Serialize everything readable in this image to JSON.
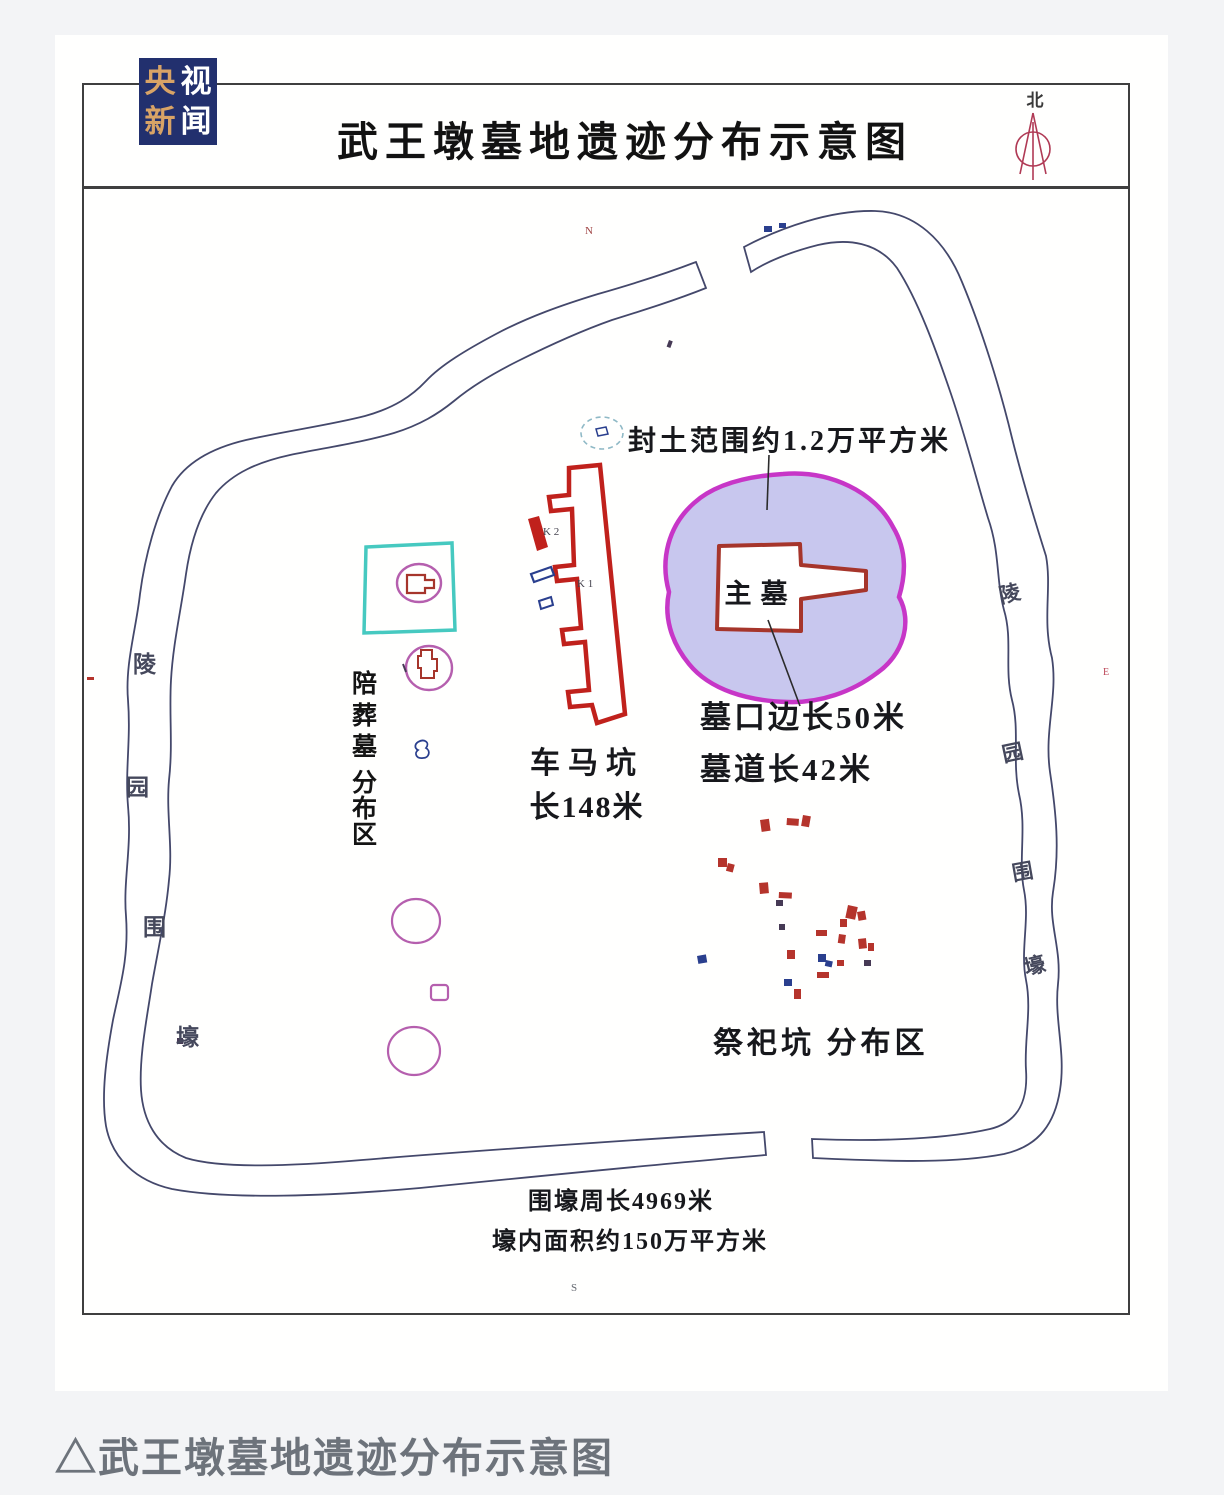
{
  "header": {
    "title": "武王墩墓地遗迹分布示意图",
    "north_label": "北"
  },
  "logo": {
    "rows": [
      [
        "央",
        "视"
      ],
      [
        "新",
        "闻"
      ]
    ]
  },
  "map": {
    "fengtu_label": "封土范围约1.2万平方米",
    "main_tomb": "主墓",
    "tomb_mouth": "墓口边长50米",
    "tomb_passage": "墓道长42米",
    "chariot_line1": "车马坑",
    "chariot_line2": "长148米",
    "k1": "K 1",
    "k2": "K 2",
    "accompany_chars": [
      "陪",
      "葬",
      "墓",
      "分",
      "布",
      "区"
    ],
    "sacrificial_label": "祭祀坑 分布区",
    "moat_left_chars": [
      "陵",
      "园",
      "围",
      "壕"
    ],
    "moat_right_chars": [
      "陵",
      "园",
      "围",
      "壕"
    ],
    "perimeter": "围壕周长4969米",
    "inner_area": "壕内面积约150万平方米",
    "tiny_marks": {
      "top": "N",
      "bottom": "S",
      "right": "E"
    },
    "marks": [
      {
        "x": 760,
        "y": 820,
        "w": 9,
        "h": 12,
        "f": "#b5342c",
        "r": -8
      },
      {
        "x": 787,
        "y": 818,
        "w": 12,
        "h": 7,
        "f": "#b5342c",
        "r": 4
      },
      {
        "x": 803,
        "y": 815,
        "w": 8,
        "h": 11,
        "f": "#b5342c",
        "r": 10
      },
      {
        "x": 718,
        "y": 858,
        "w": 9,
        "h": 9,
        "f": "#b5342c",
        "r": 0
      },
      {
        "x": 728,
        "y": 863,
        "w": 7,
        "h": 8,
        "f": "#b5342c",
        "r": 15
      },
      {
        "x": 759,
        "y": 883,
        "w": 9,
        "h": 11,
        "f": "#b5342c",
        "r": -5
      },
      {
        "x": 779,
        "y": 892,
        "w": 13,
        "h": 6,
        "f": "#b5342c",
        "r": 3
      },
      {
        "x": 776,
        "y": 900,
        "w": 7,
        "h": 6,
        "f": "#463a55",
        "r": 0
      },
      {
        "x": 848,
        "y": 905,
        "w": 10,
        "h": 13,
        "f": "#b5342c",
        "r": 12
      },
      {
        "x": 857,
        "y": 912,
        "w": 8,
        "h": 9,
        "f": "#b5342c",
        "r": -10
      },
      {
        "x": 840,
        "y": 919,
        "w": 7,
        "h": 8,
        "f": "#b5342c",
        "r": 0
      },
      {
        "x": 779,
        "y": 924,
        "w": 6,
        "h": 6,
        "f": "#463a55",
        "r": 0
      },
      {
        "x": 816,
        "y": 930,
        "w": 11,
        "h": 6,
        "f": "#b5342c",
        "r": 0
      },
      {
        "x": 839,
        "y": 934,
        "w": 7,
        "h": 9,
        "f": "#b5342c",
        "r": 8
      },
      {
        "x": 858,
        "y": 939,
        "w": 8,
        "h": 10,
        "f": "#b5342c",
        "r": -6
      },
      {
        "x": 868,
        "y": 943,
        "w": 6,
        "h": 8,
        "f": "#b5342c",
        "r": 0
      },
      {
        "x": 787,
        "y": 950,
        "w": 8,
        "h": 9,
        "f": "#b5342c",
        "r": 0
      },
      {
        "x": 697,
        "y": 956,
        "w": 9,
        "h": 8,
        "f": "#2a3f8e",
        "r": -10
      },
      {
        "x": 818,
        "y": 954,
        "w": 8,
        "h": 8,
        "f": "#2a3f8e",
        "r": 0
      },
      {
        "x": 826,
        "y": 960,
        "w": 7,
        "h": 6,
        "f": "#2a3f8e",
        "r": 12
      },
      {
        "x": 837,
        "y": 960,
        "w": 7,
        "h": 6,
        "f": "#b5342c",
        "r": 0
      },
      {
        "x": 864,
        "y": 960,
        "w": 7,
        "h": 6,
        "f": "#463a55",
        "r": 0
      },
      {
        "x": 817,
        "y": 972,
        "w": 12,
        "h": 6,
        "f": "#b5342c",
        "r": 0
      },
      {
        "x": 784,
        "y": 979,
        "w": 8,
        "h": 7,
        "f": "#2a3f8e",
        "r": 0
      },
      {
        "x": 794,
        "y": 989,
        "w": 7,
        "h": 10,
        "f": "#b5342c",
        "r": 0
      },
      {
        "x": 764,
        "y": 226,
        "w": 8,
        "h": 6,
        "f": "#2a3f8e",
        "r": 0
      },
      {
        "x": 779,
        "y": 223,
        "w": 7,
        "h": 5,
        "f": "#2a3f8e",
        "r": 0
      },
      {
        "x": 669,
        "y": 340,
        "w": 4,
        "h": 7,
        "f": "#463a55",
        "r": 20
      },
      {
        "x": 177,
        "y": 1038,
        "w": 6,
        "h": 6,
        "f": "#463a55",
        "r": 0
      },
      {
        "x": 87,
        "y": 677,
        "w": 7,
        "h": 3,
        "f": "#b5342c",
        "r": 0
      }
    ]
  },
  "caption": {
    "text": "△武王墩墓地遗迹分布示意图"
  },
  "colors": {
    "page_bg": "#f3f4f6",
    "card_bg": "#fffffe",
    "frame": "#3f3f3f",
    "moat": "#44486b",
    "chariot_red": "#c0211c",
    "tomb_red": "#a6352b",
    "mound_fill": "#c8c7ee",
    "mound_stroke": "#c736c7",
    "cyan": "#46c9c0",
    "pink": "#b55fae",
    "blue": "#2a3f8e",
    "logo_bg": "#22306e",
    "logo_gold": "#d8a366",
    "north_red": "#b03a55",
    "caption_gray": "#6d737b"
  }
}
